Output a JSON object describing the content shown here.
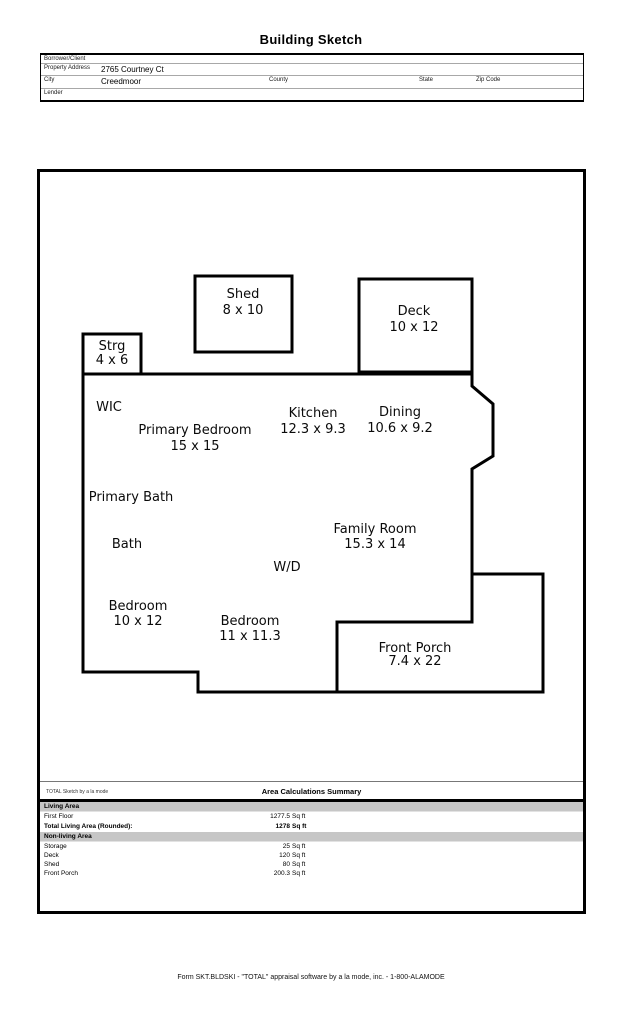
{
  "page": {
    "title": "Building Sketch",
    "footer": "Form SKT.BLDSKI - \"TOTAL\" appraisal software by a la mode, inc. - 1-800-ALAMODE"
  },
  "header_form": {
    "rows": [
      {
        "label": "Borrower/Client",
        "value": ""
      },
      {
        "label": "Property Address",
        "value": "2765 Courtney Ct"
      },
      {
        "label": "City",
        "value": "Creedmoor"
      },
      {
        "label": "Lender",
        "value": ""
      }
    ],
    "extra_labels": {
      "county": "County",
      "state": "State",
      "zip": "Zip Code"
    }
  },
  "rooms": [
    {
      "name": "Shed",
      "dims": "8 x 10"
    },
    {
      "name": "Deck",
      "dims": "10 x 12"
    },
    {
      "name": "Strg",
      "dims": "4 x 6"
    },
    {
      "name": "WIC"
    },
    {
      "name": "Primary Bedroom",
      "dims": "15 x 15"
    },
    {
      "name": "Kitchen",
      "dims": "12.3 x 9.3"
    },
    {
      "name": "Dining",
      "dims": "10.6 x 9.2"
    },
    {
      "name": "Primary Bath"
    },
    {
      "name": "Bath"
    },
    {
      "name": "Family Room",
      "dims": "15.3 x 14"
    },
    {
      "name": "W/D"
    },
    {
      "name": "Bedroom",
      "dims": "10 x 12"
    },
    {
      "name": "Bedroom",
      "dims": "11 x 11.3"
    },
    {
      "name": "Front Porch",
      "dims": "7.4 x 22"
    }
  ],
  "area_summary": {
    "watermark": "TOTAL Sketch by a la mode",
    "title": "Area Calculations Summary",
    "living_header": "Living Area",
    "first_floor": {
      "label": "First Floor",
      "value": "1277.5",
      "unit": "Sq ft"
    },
    "total_row": {
      "label": "Total Living Area (Rounded):",
      "value": "1278",
      "unit": "Sq ft"
    },
    "nonliving_header": "Non-living Area",
    "nonliving_rows": [
      {
        "label": "Storage",
        "value": "25",
        "unit": "Sq ft"
      },
      {
        "label": "Deck",
        "value": "120",
        "unit": "Sq ft"
      },
      {
        "label": "Shed",
        "value": "80",
        "unit": "Sq ft"
      },
      {
        "label": "Front Porch",
        "value": "200.3",
        "unit": "Sq ft"
      }
    ]
  }
}
